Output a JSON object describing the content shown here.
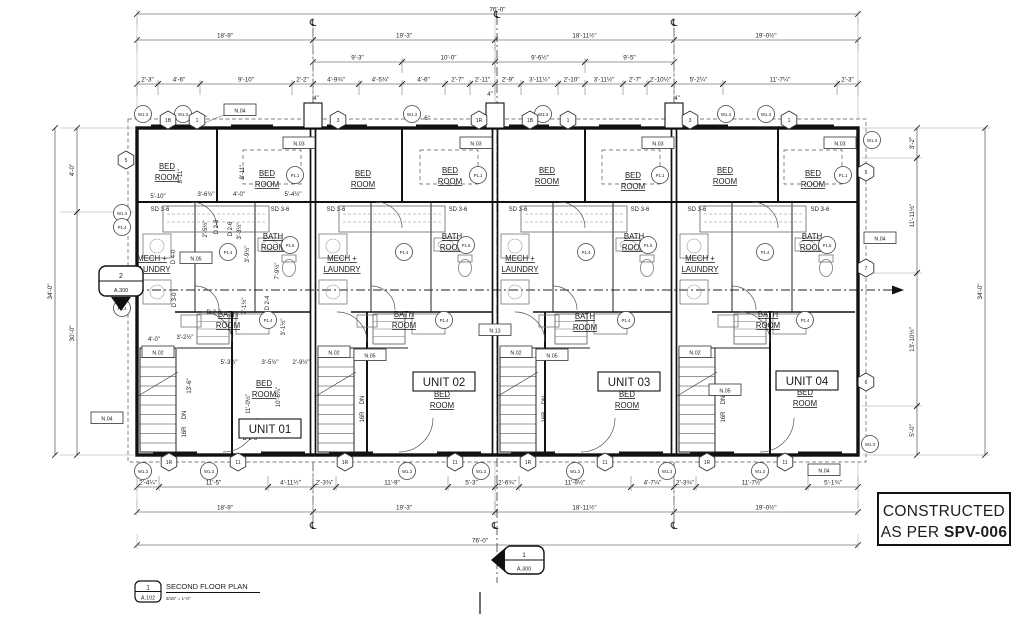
{
  "stamp": {
    "line1": "CONSTRUCTED",
    "line2_prefix": "AS PER ",
    "line2_bold": "SPV-006"
  },
  "titleblock": {
    "num": "1",
    "sheet": "A.102",
    "name": "SECOND FLOOR PLAN",
    "scale": "3/16\" = 1'-0\""
  },
  "markers": {
    "section_left": {
      "num": "2",
      "sheet": "A.300"
    },
    "section_bottom": {
      "num": "1",
      "sheet": "A.300"
    }
  },
  "cl_symbol": "℄",
  "units": [
    {
      "label": "UNIT 01",
      "x": 270,
      "y": 429
    },
    {
      "label": "UNIT 02",
      "x": 444,
      "y": 382
    },
    {
      "label": "UNIT 03",
      "x": 629,
      "y": 382
    },
    {
      "label": "UNIT 04",
      "x": 807,
      "y": 381
    }
  ],
  "room_names": {
    "bed": [
      "BED",
      "ROOM"
    ],
    "bath": [
      "BATH",
      "ROOM"
    ],
    "mech": [
      "MECH +",
      "LAUNDRY"
    ]
  },
  "room_labels": {
    "bed_top": [
      [
        167,
        169
      ],
      [
        267,
        176
      ],
      [
        363,
        176
      ],
      [
        450,
        173
      ],
      [
        547,
        173
      ],
      [
        633,
        178
      ],
      [
        725,
        173
      ],
      [
        813,
        176
      ]
    ],
    "bed_low": [
      [
        264,
        386
      ],
      [
        442,
        397
      ],
      [
        627,
        397
      ],
      [
        805,
        395
      ]
    ],
    "bath_up": [
      [
        273,
        239
      ],
      [
        452,
        239
      ],
      [
        634,
        239
      ],
      [
        812,
        239
      ]
    ],
    "bath_low": [
      [
        228,
        317
      ],
      [
        404,
        317
      ],
      [
        585,
        319
      ],
      [
        768,
        317
      ]
    ],
    "mech": [
      [
        152,
        261
      ],
      [
        342,
        261
      ],
      [
        520,
        261
      ],
      [
        700,
        261
      ]
    ]
  },
  "dims_h": [
    {
      "t": "76'-0\"",
      "x1": 137,
      "x2": 858,
      "y": 14
    },
    {
      "t": "18'-9\"",
      "x1": 137,
      "x2": 313,
      "y": 40
    },
    {
      "t": "19'-3\"",
      "x1": 313,
      "x2": 495,
      "y": 40
    },
    {
      "t": "18'-11½\"",
      "x1": 495,
      "x2": 674,
      "y": 40
    },
    {
      "t": "19'-0½\"",
      "x1": 674,
      "x2": 858,
      "y": 40
    },
    {
      "t": "9'-3\"",
      "x1": 313,
      "x2": 402,
      "y": 62
    },
    {
      "t": "10'-0\"",
      "x1": 402,
      "x2": 495,
      "y": 62
    },
    {
      "t": "9'-6½\"",
      "x1": 495,
      "x2": 585,
      "y": 62
    },
    {
      "t": "9'-5\"",
      "x1": 585,
      "x2": 674,
      "y": 62
    },
    {
      "t": "2'-3\"",
      "x1": 137,
      "x2": 158,
      "y": 84
    },
    {
      "t": "4'-6\"",
      "x1": 158,
      "x2": 200,
      "y": 84
    },
    {
      "t": "9'-10\"",
      "x1": 200,
      "x2": 292,
      "y": 84
    },
    {
      "t": "2'-2\"",
      "x1": 292,
      "x2": 313,
      "y": 84
    },
    {
      "t": "4'-9¾\"",
      "x1": 313,
      "x2": 359,
      "y": 84
    },
    {
      "t": "4'-5¾\"",
      "x1": 359,
      "x2": 402,
      "y": 84
    },
    {
      "t": "4'-6\"",
      "x1": 402,
      "x2": 445,
      "y": 84
    },
    {
      "t": "2'-7\"",
      "x1": 445,
      "x2": 470,
      "y": 84
    },
    {
      "t": "2'-11\"",
      "x1": 470,
      "x2": 495,
      "y": 84
    },
    {
      "t": "2'-9\"",
      "x1": 495,
      "x2": 521,
      "y": 84
    },
    {
      "t": "3'-11½\"",
      "x1": 521,
      "x2": 558,
      "y": 84
    },
    {
      "t": "2'-10\"",
      "x1": 558,
      "x2": 585,
      "y": 84
    },
    {
      "t": "3'-11½\"",
      "x1": 585,
      "x2": 623,
      "y": 84
    },
    {
      "t": "2'-7\"",
      "x1": 623,
      "x2": 647,
      "y": 84
    },
    {
      "t": "2'-10½\"",
      "x1": 647,
      "x2": 674,
      "y": 84
    },
    {
      "t": "5'-2¼\"",
      "x1": 674,
      "x2": 723,
      "y": 84
    },
    {
      "t": "11'-7¼\"",
      "x1": 723,
      "x2": 837,
      "y": 84
    },
    {
      "t": "2'-3\"",
      "x1": 837,
      "x2": 858,
      "y": 84
    },
    {
      "t": "2'-4¼\"",
      "x1": 137,
      "x2": 159,
      "y": 487
    },
    {
      "t": "11'-5\"",
      "x1": 159,
      "x2": 268,
      "y": 487
    },
    {
      "t": "4'-11½\"",
      "x1": 268,
      "x2": 313,
      "y": 487
    },
    {
      "t": "2'-3¾\"",
      "x1": 313,
      "x2": 336,
      "y": 487
    },
    {
      "t": "11'-9\"",
      "x1": 336,
      "x2": 448,
      "y": 487
    },
    {
      "t": "5'-3\"",
      "x1": 448,
      "x2": 495,
      "y": 487
    },
    {
      "t": "2'-6¾\"",
      "x1": 495,
      "x2": 519,
      "y": 487
    },
    {
      "t": "11'-9½\"",
      "x1": 519,
      "x2": 631,
      "y": 487
    },
    {
      "t": "4'-7¼\"",
      "x1": 631,
      "x2": 674,
      "y": 487
    },
    {
      "t": "2'-3¾\"",
      "x1": 674,
      "x2": 696,
      "y": 487
    },
    {
      "t": "11'-7½\"",
      "x1": 696,
      "x2": 808,
      "y": 487
    },
    {
      "t": "5'-1¾\"",
      "x1": 808,
      "x2": 858,
      "y": 487
    },
    {
      "t": "18'-9\"",
      "x1": 137,
      "x2": 313,
      "y": 512
    },
    {
      "t": "19'-3\"",
      "x1": 313,
      "x2": 495,
      "y": 512
    },
    {
      "t": "18'-11½\"",
      "x1": 495,
      "x2": 674,
      "y": 512
    },
    {
      "t": "19'-0½\"",
      "x1": 674,
      "x2": 858,
      "y": 512
    },
    {
      "t": "76'-0\"",
      "x1": 137,
      "x2": 858,
      "y": 545,
      "lx": 480
    }
  ],
  "dims_v": [
    {
      "t": "4'-0\"",
      "y1": 128,
      "y2": 212,
      "x": 77
    },
    {
      "t": "30'-0\"",
      "y1": 212,
      "y2": 455,
      "x": 77
    },
    {
      "t": "34'-0\"",
      "y1": 128,
      "y2": 455,
      "x": 55
    },
    {
      "t": "3'-2\"",
      "y1": 128,
      "y2": 158,
      "x": 917
    },
    {
      "t": "11'-11½\"",
      "y1": 158,
      "y2": 273,
      "x": 917
    },
    {
      "t": "13'-10½\"",
      "y1": 273,
      "y2": 406,
      "x": 917
    },
    {
      "t": "5'-0\"",
      "y1": 406,
      "y2": 455,
      "x": 917
    },
    {
      "t": "34'-0\"",
      "y1": 128,
      "y2": 455,
      "x": 985
    }
  ],
  "small_texts": [
    {
      "t": "5'-10\"",
      "x": 158,
      "y": 198
    },
    {
      "t": "3'-6½\"",
      "x": 206,
      "y": 196
    },
    {
      "t": "4'-0\"",
      "x": 239,
      "y": 196
    },
    {
      "t": "5'-4½\"",
      "x": 293,
      "y": 196
    },
    {
      "t": "8'-11\"",
      "x": 182,
      "y": 176,
      "r": -90
    },
    {
      "t": "8'-11\"",
      "x": 244,
      "y": 172,
      "r": -90
    },
    {
      "t": "2'-5½\"",
      "x": 207,
      "y": 229,
      "r": -90
    },
    {
      "t": "3'-3½\"",
      "x": 241,
      "y": 231,
      "r": -90
    },
    {
      "t": "3'-9½\"",
      "x": 249,
      "y": 254,
      "r": -90
    },
    {
      "t": "7'-9½\"",
      "x": 279,
      "y": 271,
      "r": -90
    },
    {
      "t": "7'-1½\"",
      "x": 246,
      "y": 306,
      "r": -90
    },
    {
      "t": "3'-1½\"",
      "x": 285,
      "y": 327,
      "r": -90
    },
    {
      "t": "4'-0\"",
      "x": 154,
      "y": 341
    },
    {
      "t": "3'-2½\"",
      "x": 185,
      "y": 339
    },
    {
      "t": "13'-6\"",
      "x": 191,
      "y": 386,
      "r": -90
    },
    {
      "t": "5'-3½\"",
      "x": 229,
      "y": 364
    },
    {
      "t": "3'-5½\"",
      "x": 270,
      "y": 364
    },
    {
      "t": "2'-9½\"",
      "x": 301,
      "y": 364
    },
    {
      "t": "11'-0½\"",
      "x": 250,
      "y": 404,
      "r": -90
    },
    {
      "t": "10'-6¼\"",
      "x": 280,
      "y": 397,
      "r": -90
    },
    {
      "t": "D 2-8",
      "x": 218,
      "y": 227,
      "r": -90
    },
    {
      "t": "D 2-6",
      "x": 232,
      "y": 229,
      "r": -90
    },
    {
      "t": "D 4-0",
      "x": 175,
      "y": 257,
      "r": -90
    },
    {
      "t": "D 3-0",
      "x": 176,
      "y": 300,
      "r": -90
    },
    {
      "t": "D 2-4",
      "x": 269,
      "y": 303,
      "r": -90
    },
    {
      "t": "D 2-6",
      "x": 214,
      "y": 314
    },
    {
      "t": "D 2-8",
      "x": 250,
      "y": 440
    },
    {
      "t": "SD 3-6",
      "x": 160,
      "y": 211
    },
    {
      "t": "SD 3-6",
      "x": 280,
      "y": 211
    },
    {
      "t": "SD 3-6",
      "x": 336,
      "y": 211
    },
    {
      "t": "SD 3-6",
      "x": 458,
      "y": 211
    },
    {
      "t": "SD 3-6",
      "x": 518,
      "y": 211
    },
    {
      "t": "SD 3-6",
      "x": 640,
      "y": 211
    },
    {
      "t": "SD 3-6",
      "x": 697,
      "y": 211
    },
    {
      "t": "SD 3-6",
      "x": 820,
      "y": 211
    },
    {
      "t": "4\"",
      "x": 316,
      "y": 100
    },
    {
      "t": "4\"",
      "x": 490,
      "y": 96
    },
    {
      "t": "4\"",
      "x": 677,
      "y": 100
    },
    {
      "t": "6\"",
      "x": 204,
      "y": 120
    },
    {
      "t": "6\"",
      "x": 427,
      "y": 120
    },
    {
      "t": "DN",
      "x": 186,
      "y": 415,
      "r": -90
    },
    {
      "t": "DN",
      "x": 364,
      "y": 400,
      "r": -90
    },
    {
      "t": "DN",
      "x": 546,
      "y": 400,
      "r": -90
    },
    {
      "t": "DN",
      "x": 725,
      "y": 400,
      "r": -90
    },
    {
      "t": "16R",
      "x": 186,
      "y": 432,
      "r": -90
    },
    {
      "t": "16R",
      "x": 364,
      "y": 417,
      "r": -90
    },
    {
      "t": "16R",
      "x": 546,
      "y": 417,
      "r": -90
    },
    {
      "t": "16R",
      "x": 725,
      "y": 417,
      "r": -90
    }
  ],
  "tags": {
    "circles": [
      {
        "t": "W1.3",
        "x": 143,
        "y": 114
      },
      {
        "t": "W1.3",
        "x": 183,
        "y": 114
      },
      {
        "t": "W1.3",
        "x": 412,
        "y": 114
      },
      {
        "t": "W1.3",
        "x": 543,
        "y": 114
      },
      {
        "t": "W1.3",
        "x": 726,
        "y": 114
      },
      {
        "t": "W1.3",
        "x": 766,
        "y": 114
      },
      {
        "t": "W1.3",
        "x": 143,
        "y": 471
      },
      {
        "t": "W1.3",
        "x": 209,
        "y": 471
      },
      {
        "t": "W1.3",
        "x": 407,
        "y": 471
      },
      {
        "t": "W1.3",
        "x": 481,
        "y": 471
      },
      {
        "t": "W1.3",
        "x": 575,
        "y": 471
      },
      {
        "t": "W1.3",
        "x": 667,
        "y": 471
      },
      {
        "t": "W1.3",
        "x": 760,
        "y": 471
      },
      {
        "t": "W1.3",
        "x": 122,
        "y": 213
      },
      {
        "t": "W1.3",
        "x": 872,
        "y": 140
      },
      {
        "t": "W1.3",
        "x": 870,
        "y": 444
      },
      {
        "t": "P1.4",
        "x": 122,
        "y": 227
      },
      {
        "t": "P1.4",
        "x": 122,
        "y": 308
      },
      {
        "t": "P1.4",
        "x": 228,
        "y": 252
      },
      {
        "t": "P1.4",
        "x": 268,
        "y": 320
      },
      {
        "t": "P1.4",
        "x": 404,
        "y": 252
      },
      {
        "t": "P1.4",
        "x": 444,
        "y": 320
      },
      {
        "t": "P1.4",
        "x": 586,
        "y": 252
      },
      {
        "t": "P1.4",
        "x": 626,
        "y": 320
      },
      {
        "t": "P1.4",
        "x": 765,
        "y": 252
      },
      {
        "t": "P1.4",
        "x": 805,
        "y": 320
      },
      {
        "t": "P1.5",
        "x": 290,
        "y": 245
      },
      {
        "t": "P1.5",
        "x": 466,
        "y": 245
      },
      {
        "t": "P1.5",
        "x": 648,
        "y": 245
      },
      {
        "t": "P1.5",
        "x": 827,
        "y": 245
      },
      {
        "t": "P1.1",
        "x": 295,
        "y": 175
      },
      {
        "t": "P1.1",
        "x": 478,
        "y": 175
      },
      {
        "t": "P1.1",
        "x": 660,
        "y": 175
      },
      {
        "t": "P1.1",
        "x": 843,
        "y": 175
      }
    ],
    "hexes": [
      {
        "t": "1B",
        "x": 168,
        "y": 120
      },
      {
        "t": "1",
        "x": 197,
        "y": 120
      },
      {
        "t": "3",
        "x": 338,
        "y": 120
      },
      {
        "t": "1R",
        "x": 479,
        "y": 120
      },
      {
        "t": "1B",
        "x": 530,
        "y": 120
      },
      {
        "t": "1",
        "x": 568,
        "y": 120
      },
      {
        "t": "3",
        "x": 690,
        "y": 120
      },
      {
        "t": "1",
        "x": 789,
        "y": 120
      },
      {
        "t": "1R",
        "x": 169,
        "y": 462
      },
      {
        "t": "11",
        "x": 238,
        "y": 462
      },
      {
        "t": "1R",
        "x": 345,
        "y": 462
      },
      {
        "t": "11",
        "x": 455,
        "y": 462
      },
      {
        "t": "1R",
        "x": 528,
        "y": 462
      },
      {
        "t": "11",
        "x": 605,
        "y": 462
      },
      {
        "t": "1R",
        "x": 707,
        "y": 462
      },
      {
        "t": "11",
        "x": 785,
        "y": 462
      },
      {
        "t": "5",
        "x": 126,
        "y": 160
      },
      {
        "t": "5",
        "x": 866,
        "y": 172
      },
      {
        "t": "7",
        "x": 866,
        "y": 268
      },
      {
        "t": "6",
        "x": 866,
        "y": 382
      }
    ],
    "boxes": [
      {
        "t": "N.04",
        "x": 240,
        "y": 110
      },
      {
        "t": "N.04",
        "x": 107,
        "y": 418
      },
      {
        "t": "N.04",
        "x": 880,
        "y": 238
      },
      {
        "t": "N.04",
        "x": 824,
        "y": 470
      },
      {
        "t": "N.03",
        "x": 299,
        "y": 143
      },
      {
        "t": "N.03",
        "x": 476,
        "y": 143
      },
      {
        "t": "N.03",
        "x": 658,
        "y": 143
      },
      {
        "t": "N.03",
        "x": 840,
        "y": 143
      },
      {
        "t": "N.02",
        "x": 158,
        "y": 352
      },
      {
        "t": "N.02",
        "x": 334,
        "y": 352
      },
      {
        "t": "N.02",
        "x": 516,
        "y": 352
      },
      {
        "t": "N.02",
        "x": 695,
        "y": 352
      },
      {
        "t": "N.05",
        "x": 196,
        "y": 258
      },
      {
        "t": "N.05",
        "x": 370,
        "y": 355
      },
      {
        "t": "N.05",
        "x": 552,
        "y": 355
      },
      {
        "t": "N.05",
        "x": 725,
        "y": 390
      },
      {
        "t": "N.13",
        "x": 495,
        "y": 330
      }
    ]
  },
  "centerline_symbols": [
    {
      "x": 313,
      "y": 26
    },
    {
      "x": 497,
      "y": 18
    },
    {
      "x": 674,
      "y": 26
    },
    {
      "x": 313,
      "y": 529
    },
    {
      "x": 495,
      "y": 529
    },
    {
      "x": 674,
      "y": 529
    }
  ]
}
